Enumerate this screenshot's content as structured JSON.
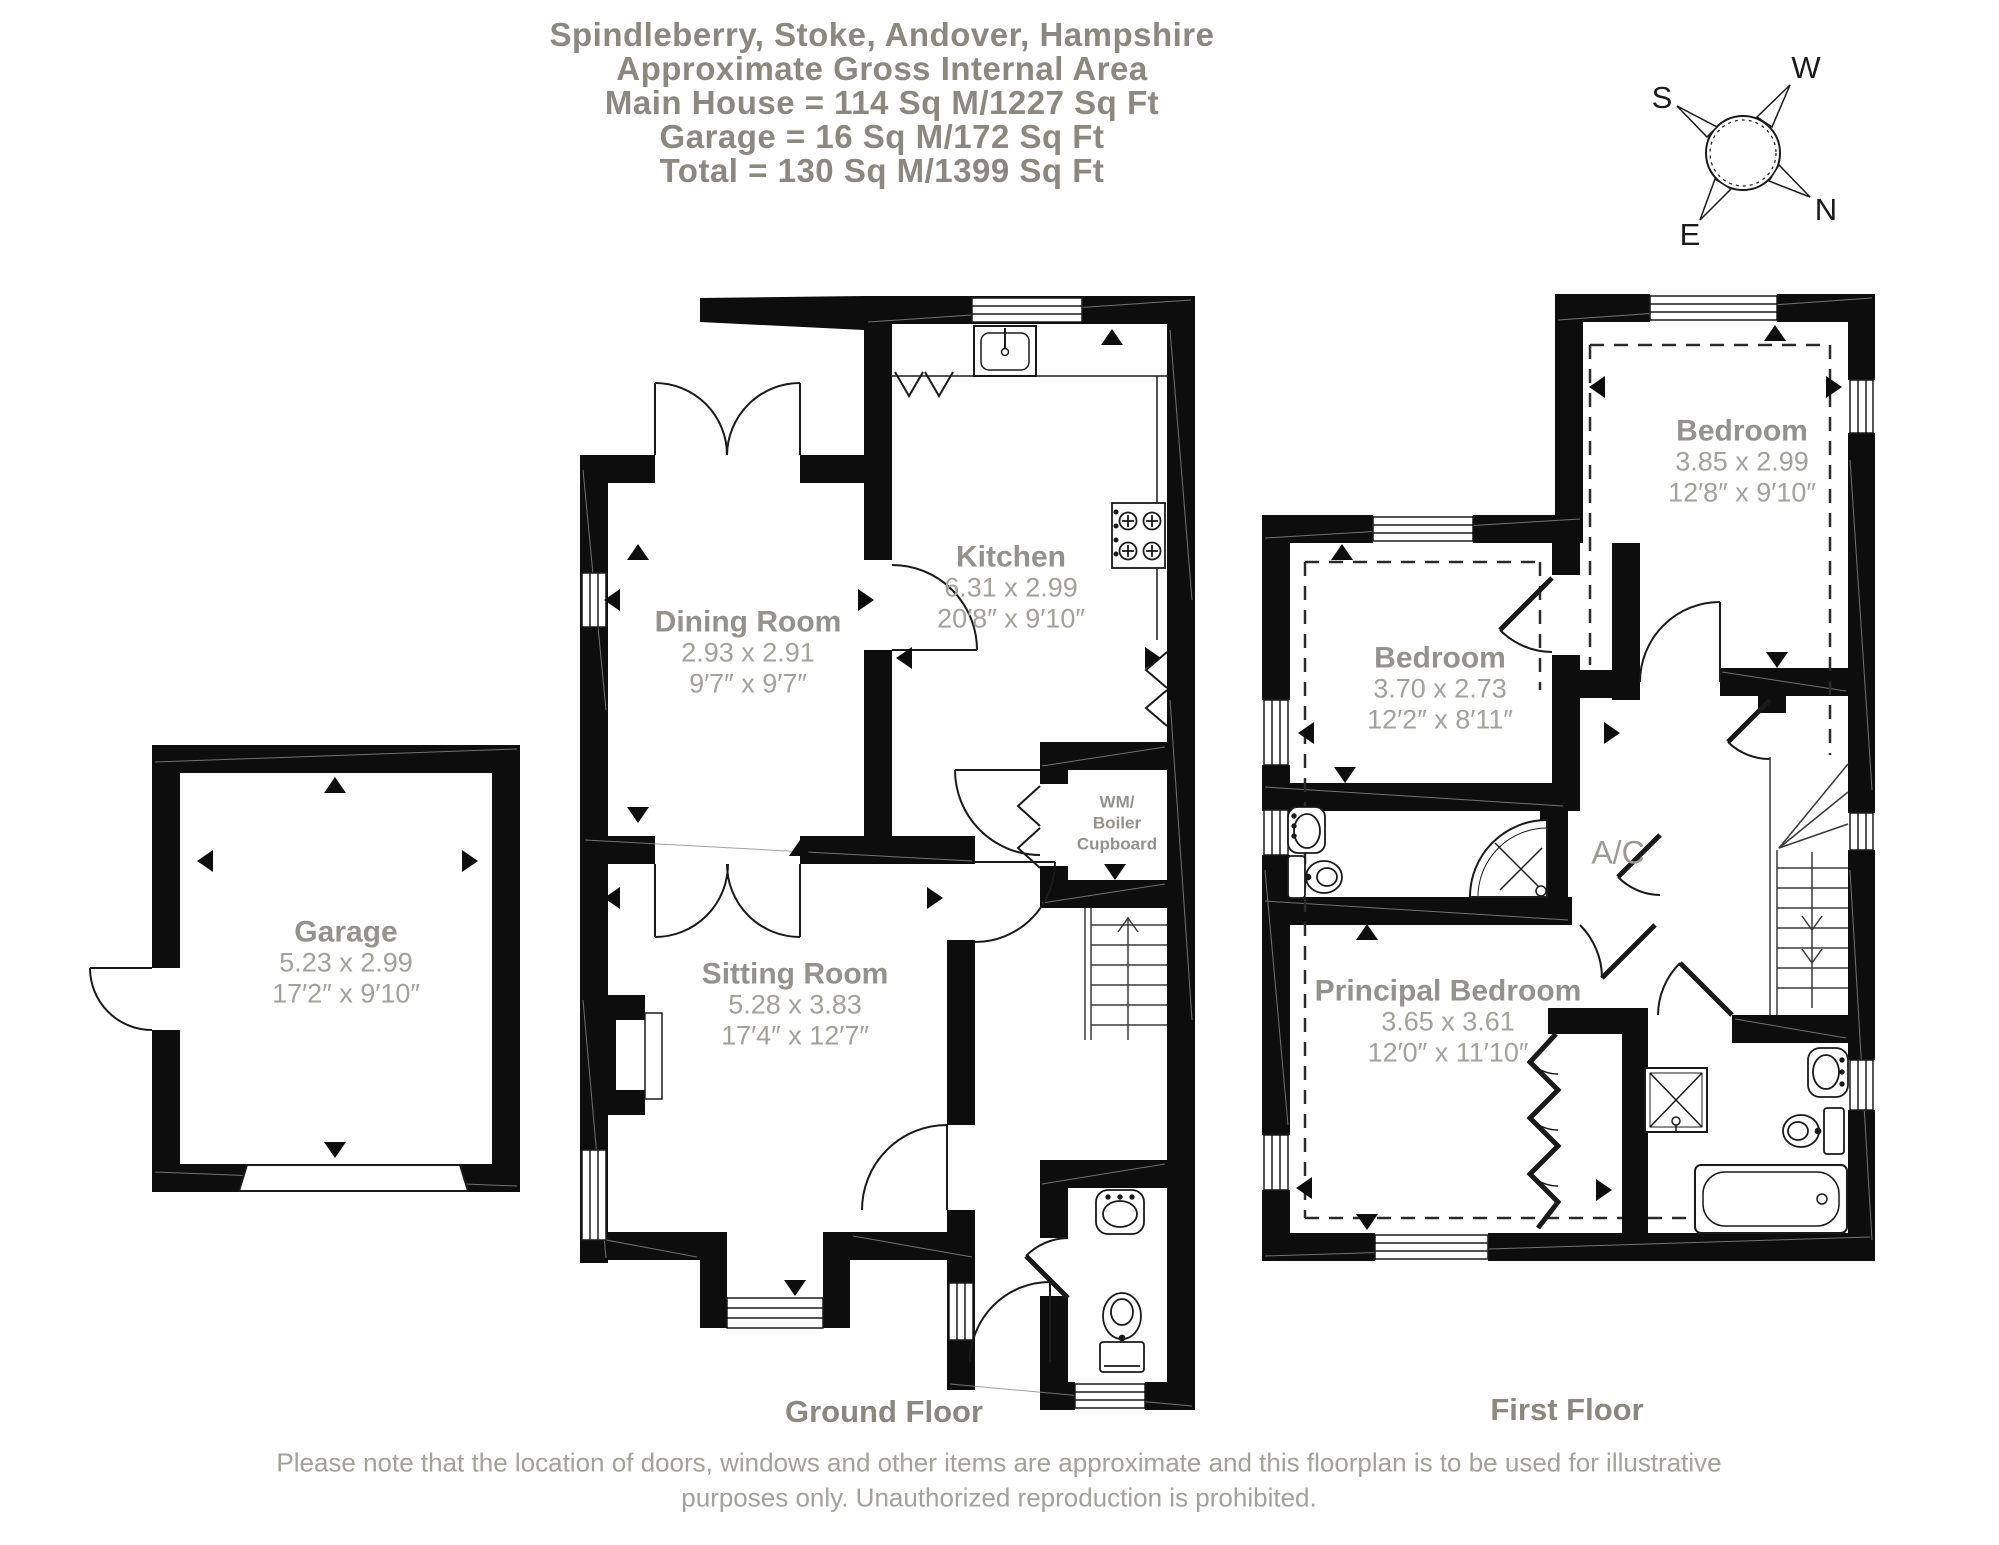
{
  "title": {
    "line1": "Spindleberry, Stoke, Andover, Hampshire",
    "line2": "Approximate Gross Internal Area",
    "line3": "Main House = 114 Sq M/1227 Sq Ft",
    "line4": "Garage = 16 Sq M/172 Sq Ft",
    "line5": "Total = 130 Sq M/1399 Sq Ft"
  },
  "compass": {
    "north": "N",
    "south": "S",
    "east": "E",
    "west": "W"
  },
  "colors": {
    "wall": "#0d0d0d",
    "heading_text": "#8b8881",
    "room_text": "#94928c",
    "dim_text": "#a3a19b"
  },
  "floors": {
    "ground": {
      "label": "Ground Floor",
      "rooms": {
        "kitchen": {
          "name": "Kitchen",
          "metric": "6.31 x 2.99",
          "imperial": "20′8″ x 9′10″"
        },
        "dining": {
          "name": "Dining Room",
          "metric": "2.93 x 2.91",
          "imperial": "9′7″ x 9′7″"
        },
        "sitting": {
          "name": "Sitting Room",
          "metric": "5.28 x 3.83",
          "imperial": "17′4″ x 12′7″"
        },
        "garage": {
          "name": "Garage",
          "metric": "5.23 x 2.99",
          "imperial": "17′2″ x 9′10″"
        },
        "cupboard": {
          "line1": "WM/",
          "line2": "Boiler",
          "line3": "Cupboard"
        }
      }
    },
    "first": {
      "label": "First Floor",
      "rooms": {
        "bedroom1": {
          "name": "Bedroom",
          "metric": "3.85 x 2.99",
          "imperial": "12′8″ x 9′10″"
        },
        "bedroom2": {
          "name": "Bedroom",
          "metric": "3.70 x 2.73",
          "imperial": "12′2″ x 8′11″"
        },
        "principal": {
          "name": "Principal Bedroom",
          "metric": "3.65 x 3.61",
          "imperial": "12′0″ x 11′10″"
        },
        "airing": {
          "label": "A/C"
        }
      }
    }
  },
  "footer": {
    "line1": "Please note that the location of doors, windows and other items are approximate and this floorplan is to be used for illustrative",
    "line2": "purposes only. Unauthorized reproduction is prohibited."
  }
}
